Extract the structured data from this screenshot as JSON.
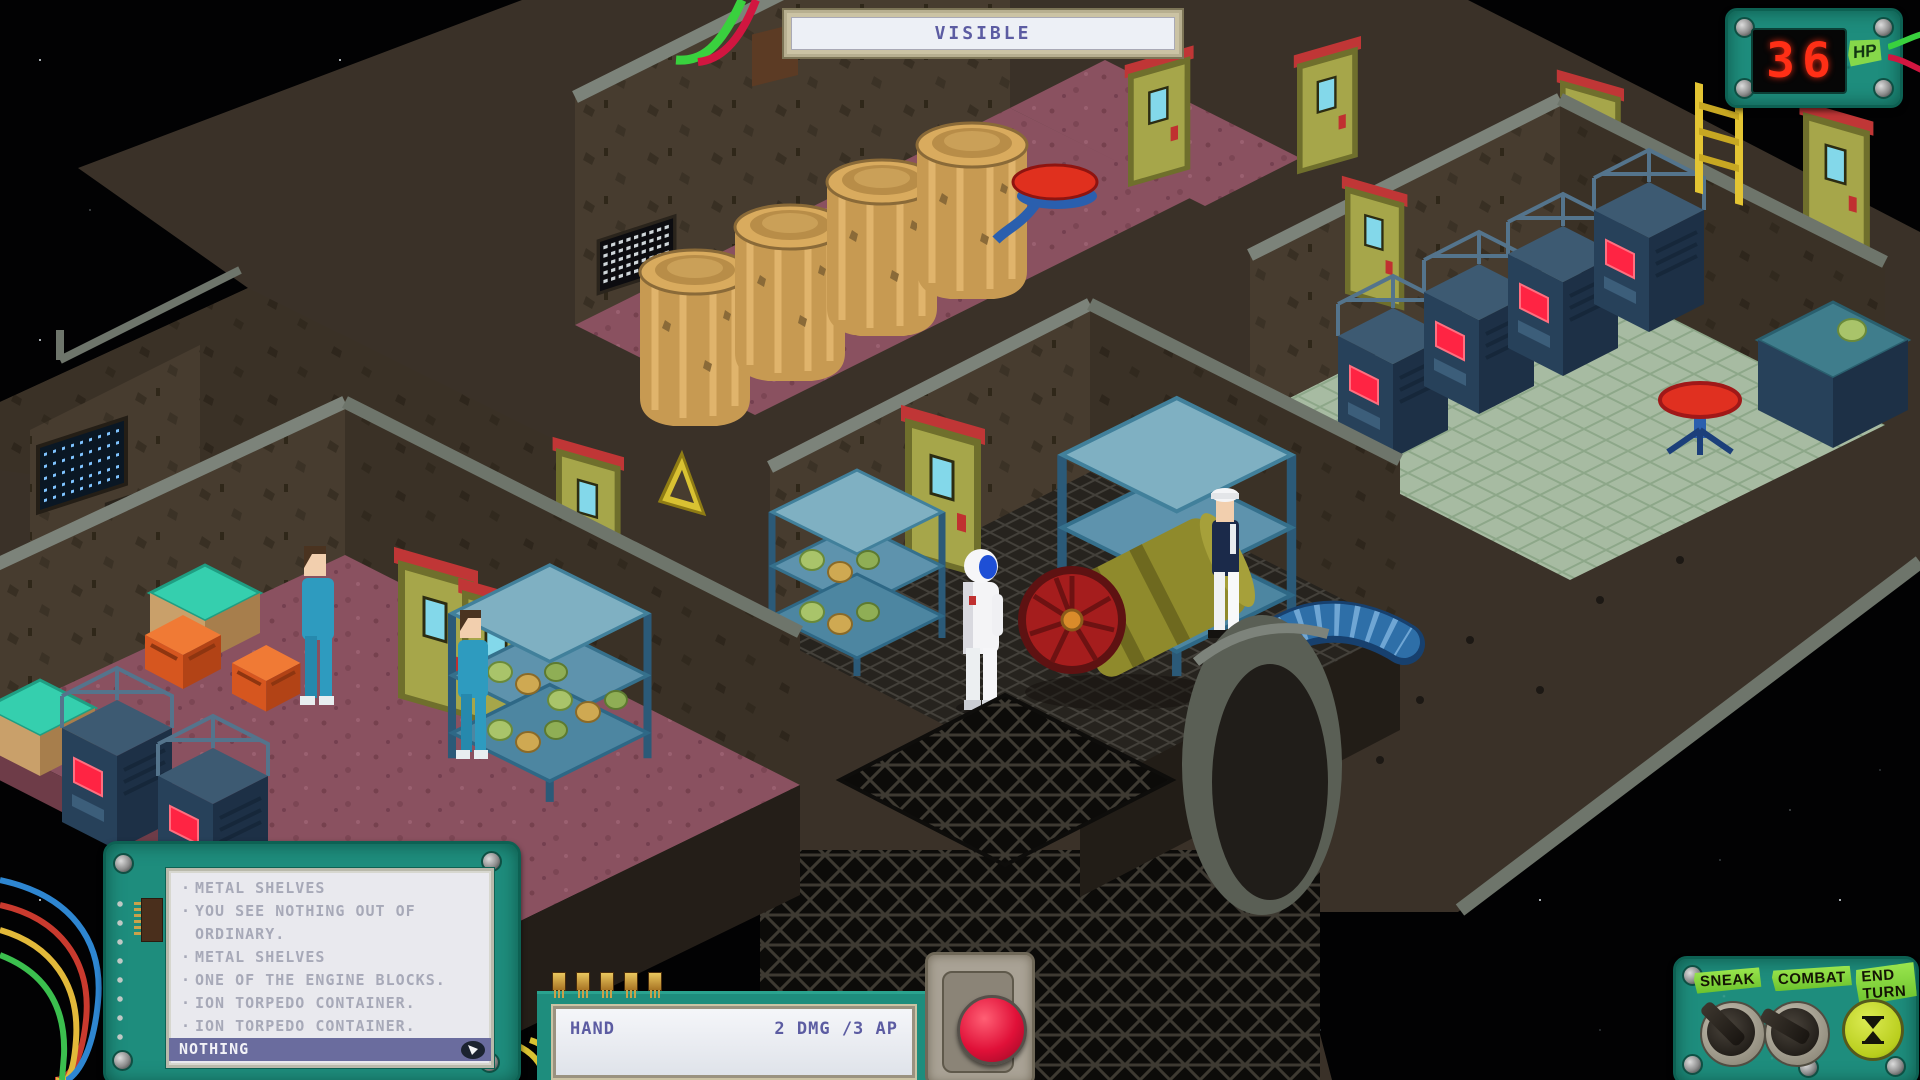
{
  "banner": {
    "label": "VISIBLE"
  },
  "hp": {
    "value": "36",
    "label": "HP"
  },
  "log": {
    "entries": [
      {
        "text": "METAL SHELVES"
      },
      {
        "text": "YOU SEE NOTHING OUT OF ORDINARY."
      },
      {
        "text": "METAL SHELVES"
      },
      {
        "text": "ONE OF THE ENGINE BLOCKS."
      },
      {
        "text": "ION TORPEDO CONTAINER."
      },
      {
        "text": "ION TORPEDO CONTAINER."
      },
      {
        "text": "NOTHING",
        "selected": true
      }
    ]
  },
  "hand": {
    "label": "HAND",
    "stats": "2 DMG /3 AP"
  },
  "controls": {
    "sneak": "SNEAK",
    "combat": "COMBAT",
    "end_turn": "END TURN"
  },
  "colors": {
    "board_teal": "#1e8d7d",
    "hp_digit_red": "#ff2f16",
    "sticker_green": "#86d84a",
    "tape_green": "#7ed63f",
    "action_button_red": "#e01038",
    "highlight_purple": "#6a6c9e",
    "ui_text_purple": "#5c5ca2",
    "log_text_gray": "#a7a9b8",
    "floor_mauve": "#8a5160",
    "floor_sage": "#a7bba2",
    "hull_brown": "#3a3128",
    "rack_screen_red": "#ff2443",
    "door_olive": "#a6a64a",
    "crew_teal": "#2e9bbf"
  }
}
